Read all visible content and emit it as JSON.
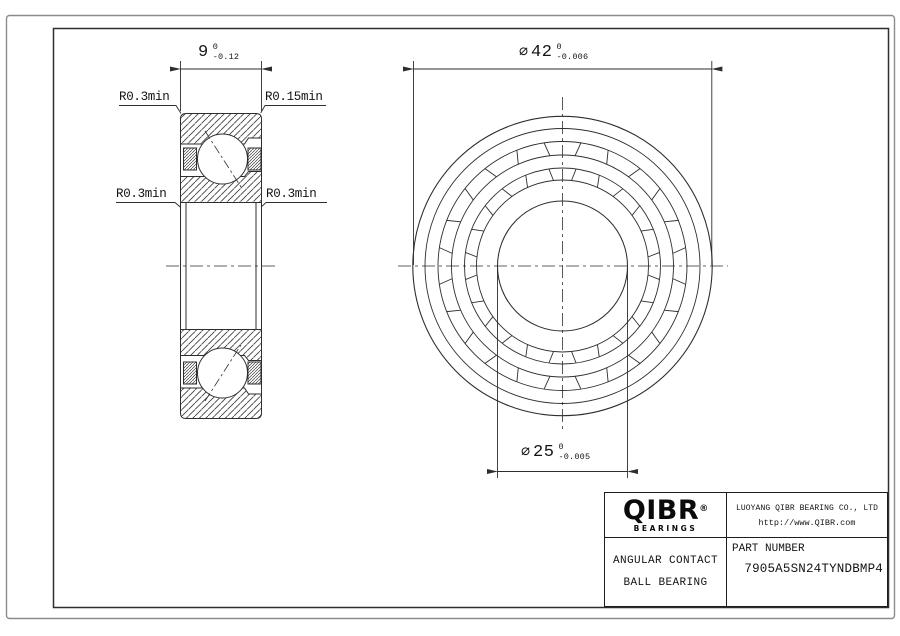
{
  "drawing": {
    "left_view": {
      "width_dim": {
        "value": "9",
        "tol_upper": "0",
        "tol_lower": "-0.12"
      },
      "labels": {
        "top_left": "R0.3min",
        "top_right": "R0.15min",
        "bottom_left": "R0.3min",
        "bottom_right": "R0.3min"
      }
    },
    "front_view": {
      "od_dim": {
        "symbol": "⌀",
        "value": "42",
        "tol_upper": "0",
        "tol_lower": "-0.006"
      },
      "bore_dim": {
        "symbol": "⌀",
        "value": "25",
        "tol_upper": "0",
        "tol_lower": "-0.005"
      }
    }
  },
  "title_block": {
    "logo": {
      "text": "QIBR",
      "reg": "®",
      "sub": "BEARINGS"
    },
    "company": "LUOYANG QIBR BEARING CO., LTD",
    "website": "http://www.QIBR.com",
    "product": {
      "line1": "ANGULAR CONTACT",
      "line2": "BALL BEARING"
    },
    "part": {
      "label": "PART NUMBER",
      "number": "7905A5SN24TYNDBMP4"
    }
  },
  "colors": {
    "line": "#2e2e2e",
    "text": "#141414",
    "frame_outer": "#8c8c8c"
  }
}
